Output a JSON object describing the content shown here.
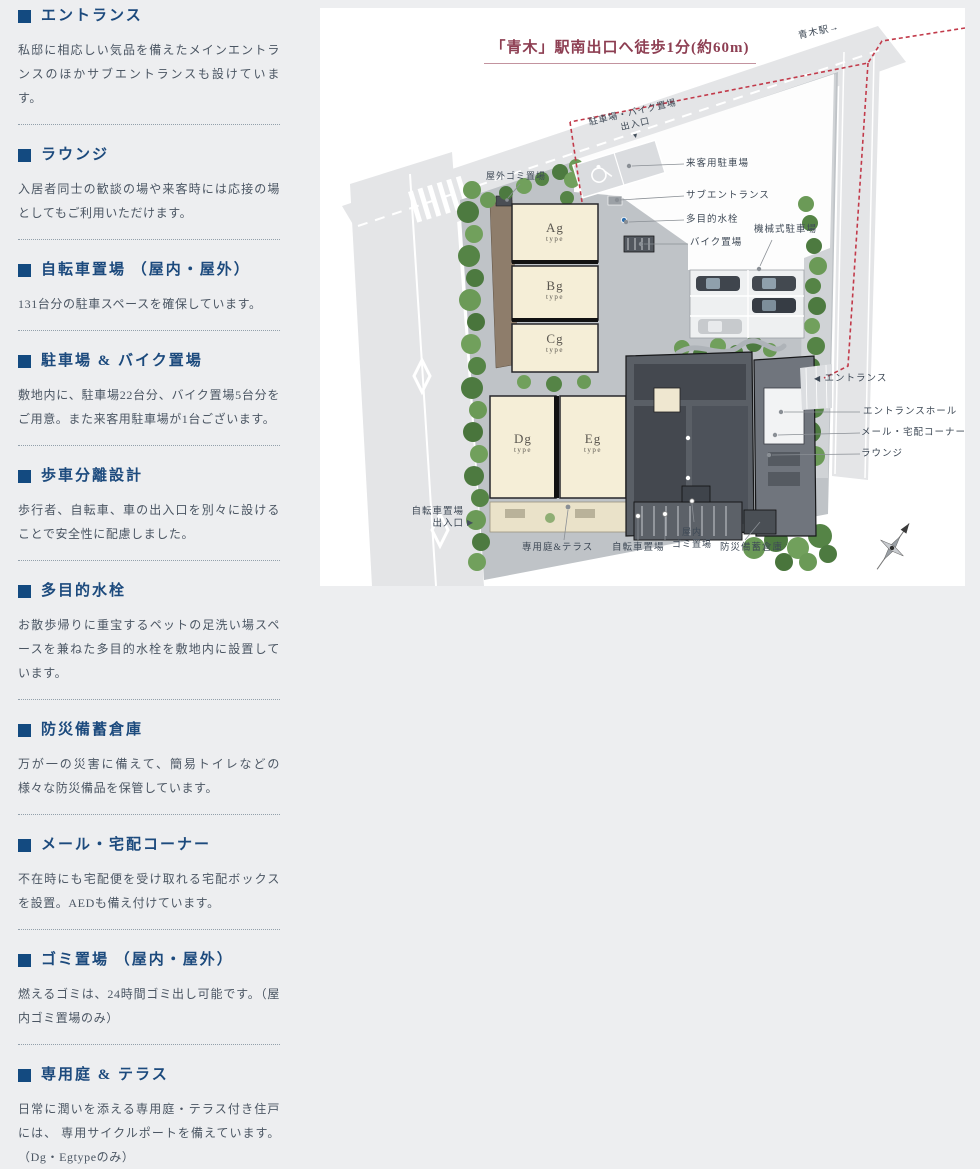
{
  "sidebar": {
    "sections": [
      {
        "title": "エントランス",
        "body": "私邸に相応しい気品を備えたメインエントランスのほかサブエントランスも設けています。"
      },
      {
        "title": "ラウンジ",
        "body": "入居者同士の歓談の場や来客時には応接の場としてもご利用いただけます。"
      },
      {
        "title": "自転車置場 （屋内・屋外）",
        "body": "131台分の駐車スペースを確保しています。"
      },
      {
        "title": "駐車場 & バイク置場",
        "body": "敷地内に、駐車場22台分、バイク置場5台分をご用意。また来客用駐車場が1台ございます。"
      },
      {
        "title": "歩車分離設計",
        "body": "歩行者、自転車、車の出入口を別々に設けることで安全性に配慮しました。"
      },
      {
        "title": "多目的水栓",
        "body": "お散歩帰りに重宝するペットの足洗い場スペースを兼ねた多目的水栓を敷地内に設置しています。"
      },
      {
        "title": "防災備蓄倉庫",
        "body": "万が一の災害に備えて、簡易トイレなどの様々な防災備品を保管しています。"
      },
      {
        "title": "メール・宅配コーナー",
        "body": "不在時にも宅配便を受け取れる宅配ボックスを設置。AEDも備え付けています。"
      },
      {
        "title": "ゴミ置場 （屋内・屋外）",
        "body": "燃えるゴミは、24時間ゴミ出し可能です。（屋内ゴミ置場のみ）"
      },
      {
        "title": "専用庭 & テラス",
        "body": "日常に潤いを添える専用庭・テラス付き住戸には、 専用サイクルポートを備えています。（Dg・Egtypeのみ）"
      }
    ]
  },
  "map": {
    "title": "「青木」駅南出口へ徒歩1分(約60m)",
    "title_color": "#8d3e52",
    "route_color": "#c23a4a",
    "station": "青木駅→",
    "labels": {
      "gate_line1": "駐車場・バイク置場",
      "gate_line2": "出入口",
      "gate_marker": "▼",
      "outdoor_garbage": "屋外ゴミ置場",
      "visitor_parking": "来客用駐車場",
      "sub_entrance": "サブエントランス",
      "multi_faucet": "多目的水栓",
      "mechanical_parking": "機械式駐車場",
      "bike_parking": "バイク置場",
      "entrance_marker": "◀",
      "entrance": "エントランス",
      "entrance_hall": "エントランスホール",
      "mail_corner": "メール・宅配コーナー",
      "lounge": "ラウンジ",
      "bicycle_gate_line1": "自転車置場",
      "bicycle_gate_line2": "出入口",
      "bicycle_gate_marker": "▶",
      "private_garden": "専用庭&テラス",
      "bicycle_parking": "自転車置場",
      "indoor_garbage_line1": "屋内",
      "indoor_garbage_line2": "ゴミ置場",
      "disaster_storage": "防災備蓄倉庫"
    },
    "buildings": [
      {
        "name": "Ag",
        "suffix": "type"
      },
      {
        "name": "Bg",
        "suffix": "type"
      },
      {
        "name": "Cg",
        "suffix": "type"
      },
      {
        "name": "Dg",
        "suffix": "type"
      },
      {
        "name": "Eg",
        "suffix": "type"
      }
    ]
  }
}
